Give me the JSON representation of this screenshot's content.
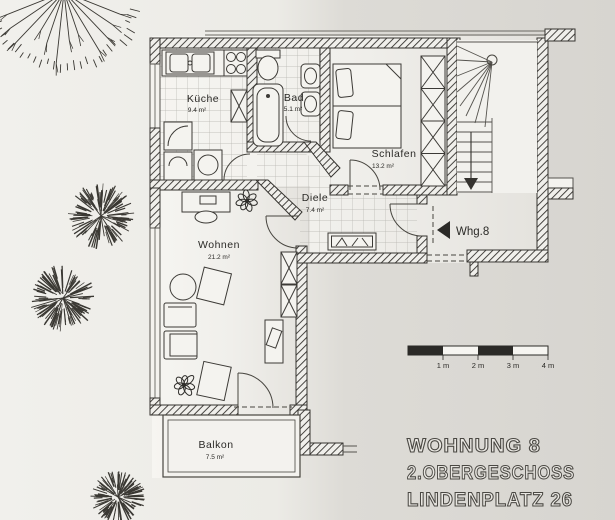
{
  "plan": {
    "rooms": [
      {
        "id": "kueche",
        "name": "Küche",
        "area": "9.4 m²"
      },
      {
        "id": "bad",
        "name": "Bad",
        "area": "5.1 m²"
      },
      {
        "id": "schlafen",
        "name": "Schlafen",
        "area": "13.2 m²"
      },
      {
        "id": "diele",
        "name": "Diele",
        "area": "7.4 m²"
      },
      {
        "id": "wohnen",
        "name": "Wohnen",
        "area": "21.2 m²"
      },
      {
        "id": "balkon",
        "name": "Balkon",
        "area": "7.5 m²"
      }
    ],
    "entrance_label": "Whg.8",
    "stair_direction": "down",
    "scale_bar": {
      "labels": [
        "1 m",
        "2 m",
        "3 m",
        "4 m"
      ]
    },
    "title_block": {
      "line1": "WOHNUNG 8",
      "line2": "2.OBERGESCHOSS",
      "line3": "LINDENPLATZ 26"
    },
    "colors": {
      "ink": "#35332f",
      "paper_light": "#f1f0ec",
      "paper_dark": "#d7d5d0"
    }
  }
}
